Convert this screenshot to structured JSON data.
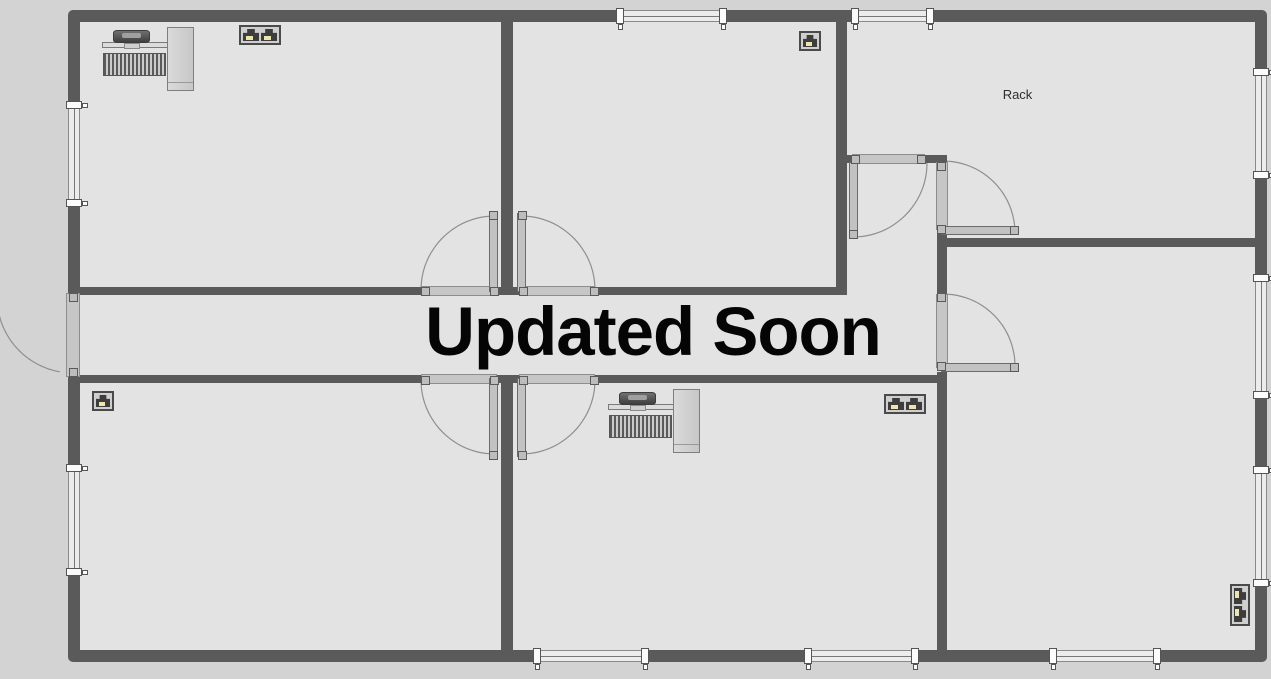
{
  "overlay": {
    "title": "Updated Soon"
  },
  "colors": {
    "canvas": "#d3d3d3",
    "floor": "#e3e3e3",
    "wall": "#5a5a5a",
    "threshold": "#c6c6c6",
    "door_leaf": "#c2c2c2",
    "arc": "#8f8f8f",
    "jack_tab": "#ece5b0",
    "text": "#050505"
  },
  "floorplan": {
    "canvas": {
      "w": 1271,
      "h": 679
    },
    "exterior": {
      "x": 68,
      "y": 10,
      "w": 1199,
      "h": 652,
      "thickness": 12
    },
    "walls": [
      {
        "name": "wall-top-rooms-divider",
        "x": 501,
        "y": 22,
        "w": 12,
        "h": 265
      },
      {
        "name": "wall-corridor-top-left",
        "x": 80,
        "y": 287,
        "w": 341,
        "h": 8
      },
      {
        "name": "wall-corridor-top-center-stub",
        "x": 497,
        "y": 287,
        "w": 22,
        "h": 8
      },
      {
        "name": "wall-corridor-top-right",
        "x": 595,
        "y": 287,
        "w": 241,
        "h": 8
      },
      {
        "name": "wall-topmiddle-room-right",
        "x": 836,
        "y": 22,
        "w": 11,
        "h": 273
      },
      {
        "name": "wall-vestibule-top-left-stub",
        "x": 847,
        "y": 155,
        "w": 5,
        "h": 8
      },
      {
        "name": "wall-vestibule-top-right-stub",
        "x": 925,
        "y": 155,
        "w": 22,
        "h": 8
      },
      {
        "name": "wall-right-rooms-divider-mid",
        "x": 937,
        "y": 230,
        "w": 10,
        "h": 65
      },
      {
        "name": "wall-rack-room-bottom",
        "x": 937,
        "y": 238,
        "w": 318,
        "h": 9
      },
      {
        "name": "wall-corridor-bottom-left",
        "x": 80,
        "y": 375,
        "w": 341,
        "h": 8
      },
      {
        "name": "wall-corridor-bottom-center-stub",
        "x": 497,
        "y": 375,
        "w": 22,
        "h": 8
      },
      {
        "name": "wall-corridor-bottom-right",
        "x": 595,
        "y": 375,
        "w": 342,
        "h": 8
      },
      {
        "name": "wall-right-rooms-divider-lower",
        "x": 937,
        "y": 372,
        "w": 10,
        "h": 278
      },
      {
        "name": "wall-bottom-rooms-divider",
        "x": 501,
        "y": 383,
        "w": 12,
        "h": 267
      }
    ],
    "windows": [
      {
        "name": "window-top-1",
        "orient": "h",
        "x": 620,
        "y": 10,
        "w": 103,
        "h": 12
      },
      {
        "name": "window-top-2",
        "orient": "h",
        "x": 855,
        "y": 10,
        "w": 75,
        "h": 12
      },
      {
        "name": "window-bottom-1",
        "orient": "h",
        "x": 537,
        "y": 650,
        "w": 108,
        "h": 12
      },
      {
        "name": "window-bottom-2",
        "orient": "h",
        "x": 808,
        "y": 650,
        "w": 107,
        "h": 12
      },
      {
        "name": "window-bottom-3",
        "orient": "h",
        "x": 1053,
        "y": 650,
        "w": 104,
        "h": 12
      },
      {
        "name": "window-left-1",
        "orient": "v",
        "x": 68,
        "y": 105,
        "w": 12,
        "h": 98
      },
      {
        "name": "window-left-2",
        "orient": "v",
        "x": 68,
        "y": 468,
        "w": 12,
        "h": 104
      },
      {
        "name": "window-right-1",
        "orient": "v",
        "x": 1255,
        "y": 72,
        "w": 12,
        "h": 103
      },
      {
        "name": "window-right-2",
        "orient": "v",
        "x": 1255,
        "y": 278,
        "w": 12,
        "h": 117
      },
      {
        "name": "window-right-3",
        "orient": "v",
        "x": 1255,
        "y": 470,
        "w": 12,
        "h": 113
      }
    ],
    "doors": [
      {
        "name": "door-corridor-upper-left",
        "threshold": {
          "x": 421,
          "y": 286,
          "w": 76,
          "h": 10
        },
        "leaf": {
          "x": 489,
          "y": 213,
          "w": 9,
          "h": 79
        },
        "arc": {
          "cx": 495,
          "cy": 290,
          "r": 74,
          "a0": 180,
          "a1": 270
        },
        "handles": [
          [
            425,
            291
          ],
          [
            494,
            291
          ],
          [
            493,
            215
          ]
        ]
      },
      {
        "name": "door-corridor-upper-right",
        "threshold": {
          "x": 519,
          "y": 286,
          "w": 76,
          "h": 10
        },
        "leaf": {
          "x": 517,
          "y": 213,
          "w": 9,
          "h": 79
        },
        "arc": {
          "cx": 521,
          "cy": 290,
          "r": 74,
          "a0": 270,
          "a1": 360
        },
        "handles": [
          [
            594,
            291
          ],
          [
            523,
            291
          ],
          [
            522,
            215
          ]
        ]
      },
      {
        "name": "door-corridor-lower-left",
        "threshold": {
          "x": 421,
          "y": 374,
          "w": 76,
          "h": 10
        },
        "leaf": {
          "x": 489,
          "y": 378,
          "w": 9,
          "h": 79
        },
        "arc": {
          "cx": 495,
          "cy": 380,
          "r": 74,
          "a0": 90,
          "a1": 180
        },
        "handles": [
          [
            425,
            380
          ],
          [
            494,
            380
          ],
          [
            493,
            455
          ]
        ]
      },
      {
        "name": "door-corridor-lower-right",
        "threshold": {
          "x": 519,
          "y": 374,
          "w": 76,
          "h": 10
        },
        "leaf": {
          "x": 517,
          "y": 378,
          "w": 9,
          "h": 79
        },
        "arc": {
          "cx": 521,
          "cy": 380,
          "r": 74,
          "a0": 0,
          "a1": 90
        },
        "handles": [
          [
            594,
            380
          ],
          [
            523,
            380
          ],
          [
            522,
            455
          ]
        ]
      },
      {
        "name": "door-exterior-left",
        "threshold": {
          "x": 66,
          "y": 293,
          "w": 14,
          "h": 84
        },
        "leaf": null,
        "arc": {
          "cx": 73,
          "cy": 297,
          "r": 76,
          "a0": 100,
          "a1": 170
        },
        "handles": [
          [
            73,
            297
          ],
          [
            73,
            372
          ]
        ]
      },
      {
        "name": "door-vestibule-top",
        "threshold": {
          "x": 852,
          "y": 154,
          "w": 73,
          "h": 10
        },
        "leaf": {
          "x": 849,
          "y": 162,
          "w": 9,
          "h": 76
        },
        "arc": {
          "cx": 853,
          "cy": 163,
          "r": 74,
          "a0": 0,
          "a1": 90
        },
        "handles": [
          [
            855,
            159
          ],
          [
            921,
            159
          ],
          [
            853,
            234
          ]
        ]
      },
      {
        "name": "door-rack-room",
        "threshold": {
          "x": 936,
          "y": 162,
          "w": 12,
          "h": 68
        },
        "leaf": {
          "x": 941,
          "y": 226,
          "w": 76,
          "h": 9
        },
        "arc": {
          "cx": 943,
          "cy": 233,
          "r": 72,
          "a0": 270,
          "a1": 360
        },
        "handles": [
          [
            941,
            166
          ],
          [
            941,
            229
          ],
          [
            1014,
            230
          ]
        ]
      },
      {
        "name": "door-corridor-right",
        "threshold": {
          "x": 936,
          "y": 294,
          "w": 12,
          "h": 74
        },
        "leaf": {
          "x": 941,
          "y": 363,
          "w": 76,
          "h": 9
        },
        "arc": {
          "cx": 943,
          "cy": 366,
          "r": 72,
          "a0": 270,
          "a1": 360
        },
        "handles": [
          [
            941,
            297
          ],
          [
            941,
            366
          ],
          [
            1014,
            367
          ]
        ]
      }
    ],
    "equipment": [
      {
        "type": "workstation",
        "name": "workstation-top-left",
        "x": 100,
        "y": 27
      },
      {
        "type": "workstation",
        "name": "workstation-bottom-middle",
        "x": 606,
        "y": 389
      },
      {
        "type": "rack",
        "name": "rack",
        "x": 967,
        "y": 27,
        "w": 101,
        "h": 54,
        "label": "Rack"
      },
      {
        "type": "hub",
        "name": "hub-device",
        "x": 963,
        "y": 261,
        "w": 38,
        "h": 27
      },
      {
        "type": "jack2",
        "name": "wall-jack-double-top-left",
        "x": 239,
        "y": 25
      },
      {
        "type": "jack1",
        "name": "wall-jack-single-top-middle",
        "x": 799,
        "y": 31
      },
      {
        "type": "jack1",
        "name": "wall-jack-single-bottom-left",
        "x": 92,
        "y": 391
      },
      {
        "type": "jack2",
        "name": "wall-jack-double-bottom-middle",
        "x": 884,
        "y": 394
      },
      {
        "type": "jack2v",
        "name": "wall-jack-double-right",
        "x": 1219,
        "y": 595
      }
    ]
  }
}
